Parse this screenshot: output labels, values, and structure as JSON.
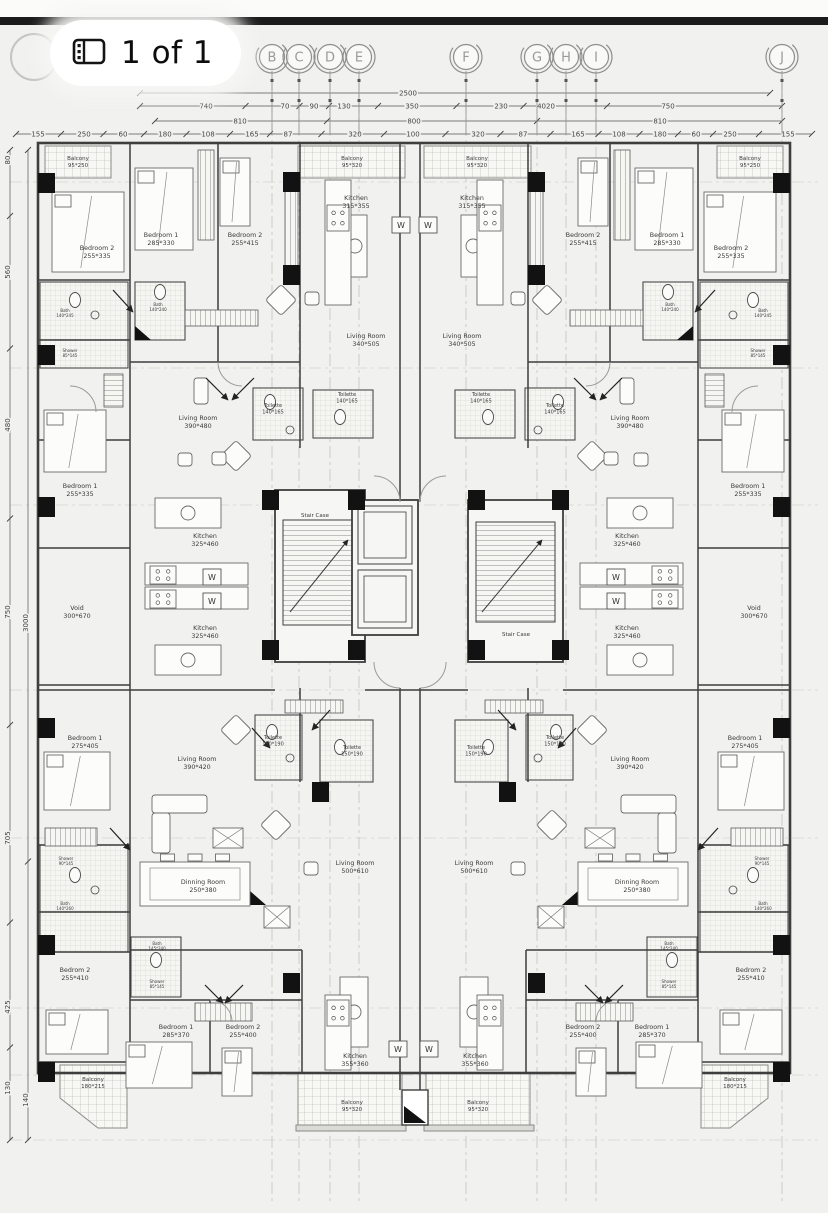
{
  "viewer": {
    "page_indicator": "1 of 1"
  },
  "colors": {
    "paper": "#f1f1ef",
    "ink": "#3a3a3a",
    "dim_text": "#444444",
    "grid_bubble": "#8f8f8f",
    "column_fill": "#121212",
    "top_band": "#1b1b1b"
  },
  "plan": {
    "grid_bubbles": [
      {
        "label": "B",
        "x": 272
      },
      {
        "label": "C",
        "x": 299
      },
      {
        "label": "D",
        "x": 330
      },
      {
        "label": "E",
        "x": 359
      },
      {
        "label": "F",
        "x": 466
      },
      {
        "label": "G",
        "x": 537
      },
      {
        "label": "H",
        "x": 566
      },
      {
        "label": "I",
        "x": 596
      },
      {
        "label": "J",
        "x": 782
      }
    ],
    "dim_rows": [
      {
        "y": 93,
        "x1": 140,
        "x2": 770,
        "labels": [
          {
            "t": "2500",
            "x": 408
          }
        ]
      },
      {
        "y": 106,
        "x1": 140,
        "x2": 782,
        "labels": [
          {
            "t": "740",
            "x": 206
          },
          {
            "t": "70",
            "x": 285
          },
          {
            "t": "90",
            "x": 314
          },
          {
            "t": "130",
            "x": 344
          },
          {
            "t": "350",
            "x": 412
          },
          {
            "t": "230",
            "x": 501
          },
          {
            "t": "4020",
            "x": 546
          },
          {
            "t": "750",
            "x": 668
          }
        ]
      },
      {
        "y": 121,
        "x1": 155,
        "x2": 782,
        "labels": [
          {
            "t": "810",
            "x": 240
          },
          {
            "t": "800",
            "x": 414
          },
          {
            "t": "810",
            "x": 660
          }
        ]
      },
      {
        "y": 134,
        "x1": 16,
        "x2": 812,
        "labels": [
          {
            "t": "155",
            "x": 38
          },
          {
            "t": "250",
            "x": 84
          },
          {
            "t": "60",
            "x": 123
          },
          {
            "t": "180",
            "x": 165
          },
          {
            "t": "108",
            "x": 208
          },
          {
            "t": "165",
            "x": 252
          },
          {
            "t": "87",
            "x": 288
          },
          {
            "t": "320",
            "x": 355
          },
          {
            "t": "100",
            "x": 413
          },
          {
            "t": "320",
            "x": 478
          },
          {
            "t": "87",
            "x": 523
          },
          {
            "t": "165",
            "x": 578
          },
          {
            "t": "108",
            "x": 619
          },
          {
            "t": "180",
            "x": 660
          },
          {
            "t": "60",
            "x": 696
          },
          {
            "t": "250",
            "x": 730
          },
          {
            "t": "155",
            "x": 788
          }
        ]
      }
    ],
    "vdim_chains": [
      {
        "x": 10,
        "y1": 150,
        "y2": 1140,
        "labels": [
          {
            "t": "80",
            "y": 160
          },
          {
            "t": "560",
            "y": 272
          },
          {
            "t": "480",
            "y": 425
          },
          {
            "t": "750",
            "y": 612
          },
          {
            "t": "705",
            "y": 838
          },
          {
            "t": "425",
            "y": 1007
          },
          {
            "t": "130",
            "y": 1088
          }
        ]
      },
      {
        "x": 28,
        "y1": 150,
        "y2": 1140,
        "labels": [
          {
            "t": "3000",
            "y": 623
          },
          {
            "t": "140",
            "y": 1100
          }
        ]
      }
    ],
    "stair_labels": [
      {
        "t": "Stair Case",
        "x": 315,
        "y": 517
      },
      {
        "t": "Stair Case",
        "x": 516,
        "y": 636
      }
    ],
    "washer_marks": [
      {
        "x": 401,
        "y": 225
      },
      {
        "x": 428,
        "y": 225
      },
      {
        "x": 212,
        "y": 577
      },
      {
        "x": 212,
        "y": 601
      },
      {
        "x": 616,
        "y": 577
      },
      {
        "x": 616,
        "y": 601
      },
      {
        "x": 398,
        "y": 1049
      },
      {
        "x": 429,
        "y": 1049
      }
    ],
    "rooms": [
      {
        "n": "Balcony",
        "s": "95*250",
        "x": 78,
        "y": 160,
        "f": 5.5
      },
      {
        "n": "Bedroom 2",
        "s": "255*335",
        "x": 97,
        "y": 250
      },
      {
        "n": "Bedroom 1",
        "s": "285*330",
        "x": 161,
        "y": 237
      },
      {
        "n": "Bedroom 2",
        "s": "255*415",
        "x": 245,
        "y": 237
      },
      {
        "n": "Balcony",
        "s": "95*320",
        "x": 352,
        "y": 160,
        "f": 5.5
      },
      {
        "n": "Kitchen",
        "s": "315*355",
        "x": 356,
        "y": 200
      },
      {
        "n": "Living Room",
        "s": "340*505",
        "x": 366,
        "y": 338
      },
      {
        "n": "Kitchen",
        "s": "315*355",
        "x": 472,
        "y": 200
      },
      {
        "n": "Balcony",
        "s": "95*320",
        "x": 477,
        "y": 160,
        "f": 5.5
      },
      {
        "n": "Living Room",
        "s": "340*505",
        "x": 462,
        "y": 338
      },
      {
        "n": "Bedroom 2",
        "s": "255*415",
        "x": 583,
        "y": 237
      },
      {
        "n": "Bedroom 1",
        "s": "285*330",
        "x": 667,
        "y": 237
      },
      {
        "n": "Bedroom 2",
        "s": "255*335",
        "x": 731,
        "y": 250
      },
      {
        "n": "Balcony",
        "s": "95*250",
        "x": 750,
        "y": 160,
        "f": 5.5
      },
      {
        "n": "Living Room",
        "s": "390*480",
        "x": 198,
        "y": 420
      },
      {
        "n": "Living Room",
        "s": "390*480",
        "x": 630,
        "y": 420
      },
      {
        "n": "Toilette",
        "s": "140*165",
        "x": 273,
        "y": 407,
        "f": 5
      },
      {
        "n": "Toilette",
        "s": "140*165",
        "x": 347,
        "y": 396,
        "f": 5
      },
      {
        "n": "Toilette",
        "s": "140*165",
        "x": 481,
        "y": 396,
        "f": 5
      },
      {
        "n": "Toilette",
        "s": "140*165",
        "x": 555,
        "y": 407,
        "f": 5
      },
      {
        "n": "Bedroom 1",
        "s": "255*335",
        "x": 80,
        "y": 488
      },
      {
        "n": "Bedroom 1",
        "s": "255*335",
        "x": 748,
        "y": 488
      },
      {
        "n": "Kitchen",
        "s": "325*460",
        "x": 205,
        "y": 538
      },
      {
        "n": "Kitchen",
        "s": "325*460",
        "x": 627,
        "y": 538
      },
      {
        "n": "Kitchen",
        "s": "325*460",
        "x": 205,
        "y": 630
      },
      {
        "n": "Kitchen",
        "s": "325*460",
        "x": 627,
        "y": 630
      },
      {
        "n": "Void",
        "s": "300*670",
        "x": 77,
        "y": 610
      },
      {
        "n": "Void",
        "s": "300*670",
        "x": 754,
        "y": 610
      },
      {
        "n": "Bedroom 1",
        "s": "275*405",
        "x": 85,
        "y": 740
      },
      {
        "n": "Bedroom 1",
        "s": "275*405",
        "x": 745,
        "y": 740
      },
      {
        "n": "Living Room",
        "s": "390*420",
        "x": 197,
        "y": 761
      },
      {
        "n": "Living Room",
        "s": "390*420",
        "x": 630,
        "y": 761
      },
      {
        "n": "Toilette",
        "s": "150*190",
        "x": 273,
        "y": 739,
        "f": 5
      },
      {
        "n": "Toilette",
        "s": "150*190",
        "x": 352,
        "y": 749,
        "f": 5
      },
      {
        "n": "Toilette",
        "s": "150*190",
        "x": 476,
        "y": 749,
        "f": 5
      },
      {
        "n": "Toilette",
        "s": "150*190",
        "x": 555,
        "y": 739,
        "f": 5
      },
      {
        "n": "Living Room",
        "s": "500*610",
        "x": 355,
        "y": 865
      },
      {
        "n": "Living Room",
        "s": "500*610",
        "x": 474,
        "y": 865
      },
      {
        "n": "Dinning Room",
        "s": "250*380",
        "x": 203,
        "y": 884
      },
      {
        "n": "Dinning Room",
        "s": "250*380",
        "x": 637,
        "y": 884
      },
      {
        "n": "Bedrom 2",
        "s": "255*410",
        "x": 75,
        "y": 972
      },
      {
        "n": "Bedrom 2",
        "s": "255*410",
        "x": 751,
        "y": 972
      },
      {
        "n": "Bedroom 1",
        "s": "285*370",
        "x": 176,
        "y": 1029
      },
      {
        "n": "Bedroom 2",
        "s": "255*400",
        "x": 243,
        "y": 1029
      },
      {
        "n": "Bedroom 2",
        "s": "255*400",
        "x": 583,
        "y": 1029
      },
      {
        "n": "Bedroom 1",
        "s": "285*370",
        "x": 652,
        "y": 1029
      },
      {
        "n": "Kitchen",
        "s": "355*360",
        "x": 355,
        "y": 1058
      },
      {
        "n": "Kitchen",
        "s": "355*360",
        "x": 475,
        "y": 1058
      },
      {
        "n": "Balcony",
        "s": "180*215",
        "x": 93,
        "y": 1081,
        "f": 5.5
      },
      {
        "n": "Balcony",
        "s": "180*215",
        "x": 735,
        "y": 1081,
        "f": 5.5
      },
      {
        "n": "Balcony",
        "s": "95*320",
        "x": 352,
        "y": 1104,
        "f": 5.5
      },
      {
        "n": "Balcony",
        "s": "95*320",
        "x": 478,
        "y": 1104,
        "f": 5.5
      }
    ],
    "small_labels": [
      {
        "t": "Bath",
        "s": "140*245",
        "x": 65,
        "y": 312
      },
      {
        "t": "Shower",
        "s": "85*145",
        "x": 70,
        "y": 352
      },
      {
        "t": "Bath",
        "s": "140*245",
        "x": 763,
        "y": 312
      },
      {
        "t": "Shower",
        "s": "85*145",
        "x": 758,
        "y": 352
      },
      {
        "t": "Bath",
        "s": "140*240",
        "x": 158,
        "y": 306
      },
      {
        "t": "Bath",
        "s": "140*240",
        "x": 670,
        "y": 306
      },
      {
        "t": "Shower",
        "s": "90*145",
        "x": 66,
        "y": 860
      },
      {
        "t": "Shower",
        "s": "90*145",
        "x": 762,
        "y": 860
      },
      {
        "t": "Bath",
        "s": "140*260",
        "x": 65,
        "y": 905
      },
      {
        "t": "Bath",
        "s": "140*260",
        "x": 763,
        "y": 905
      },
      {
        "t": "Bath",
        "s": "145*240",
        "x": 157,
        "y": 945
      },
      {
        "t": "Shower",
        "s": "85*145",
        "x": 157,
        "y": 983
      },
      {
        "t": "Bath",
        "s": "145*240",
        "x": 669,
        "y": 945
      },
      {
        "t": "Shower",
        "s": "85*145",
        "x": 669,
        "y": 983
      }
    ],
    "columns": [
      [
        38,
        173
      ],
      [
        38,
        345
      ],
      [
        38,
        497
      ],
      [
        38,
        718
      ],
      [
        38,
        935
      ],
      [
        38,
        1062
      ],
      [
        773,
        173
      ],
      [
        773,
        345
      ],
      [
        773,
        497
      ],
      [
        773,
        718
      ],
      [
        773,
        935
      ],
      [
        773,
        1062
      ],
      [
        283,
        172
      ],
      [
        528,
        172
      ],
      [
        283,
        265
      ],
      [
        528,
        265
      ],
      [
        262,
        490
      ],
      [
        348,
        490
      ],
      [
        468,
        490
      ],
      [
        552,
        490
      ],
      [
        262,
        640
      ],
      [
        348,
        640
      ],
      [
        468,
        640
      ],
      [
        552,
        640
      ],
      [
        312,
        782
      ],
      [
        499,
        782
      ],
      [
        283,
        973
      ],
      [
        528,
        973
      ]
    ]
  }
}
